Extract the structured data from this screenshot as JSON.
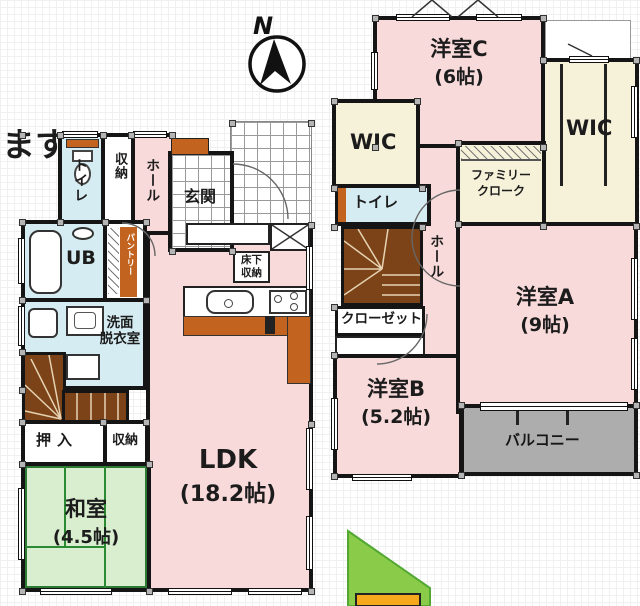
{
  "note": {
    "text": "ます)"
  },
  "compass": {
    "label": "N"
  },
  "floor1": {
    "toilet": "トイレ",
    "storage_top": "収納",
    "hall": "ホール",
    "entrance": "玄関",
    "bath": "UB",
    "pantry": "パントリー",
    "washroom_line1": "洗面",
    "washroom_line2": "脱衣室",
    "underfloor_line1": "床下",
    "underfloor_line2": "収納",
    "oshiire": "押入",
    "storage_bottom": "収納",
    "japanese_room_name": "和室",
    "japanese_room_size": "(4.5帖)",
    "ldk_name": "LDK",
    "ldk_size": "(18.2帖)"
  },
  "floor2": {
    "room_c_name": "洋室C",
    "room_c_size": "(6帖)",
    "wic_left": "WIC",
    "wic_right": "WIC",
    "family_closet_line1": "ファミリー",
    "family_closet_line2": "クローク",
    "toilet": "トイレ",
    "hall": "ホール",
    "closet": "クローゼット",
    "room_b_name": "洋室B",
    "room_b_size": "(5.2帖)",
    "room_a_name": "洋室A",
    "room_a_size": "(9帖)",
    "balcony": "バルコニー"
  },
  "colors": {
    "room_pink": "#f9dada",
    "wet_blue": "#d5ecf2",
    "closet_cream": "#f6f1d9",
    "tatami_green": "#d8eecf",
    "stair_brown": "#7c4318",
    "counter_orange": "#c2641f",
    "balcony_gray": "#adadad",
    "wall_black": "#151515",
    "site_green": "#8bcb4a",
    "site_orange": "#f5a81c"
  }
}
